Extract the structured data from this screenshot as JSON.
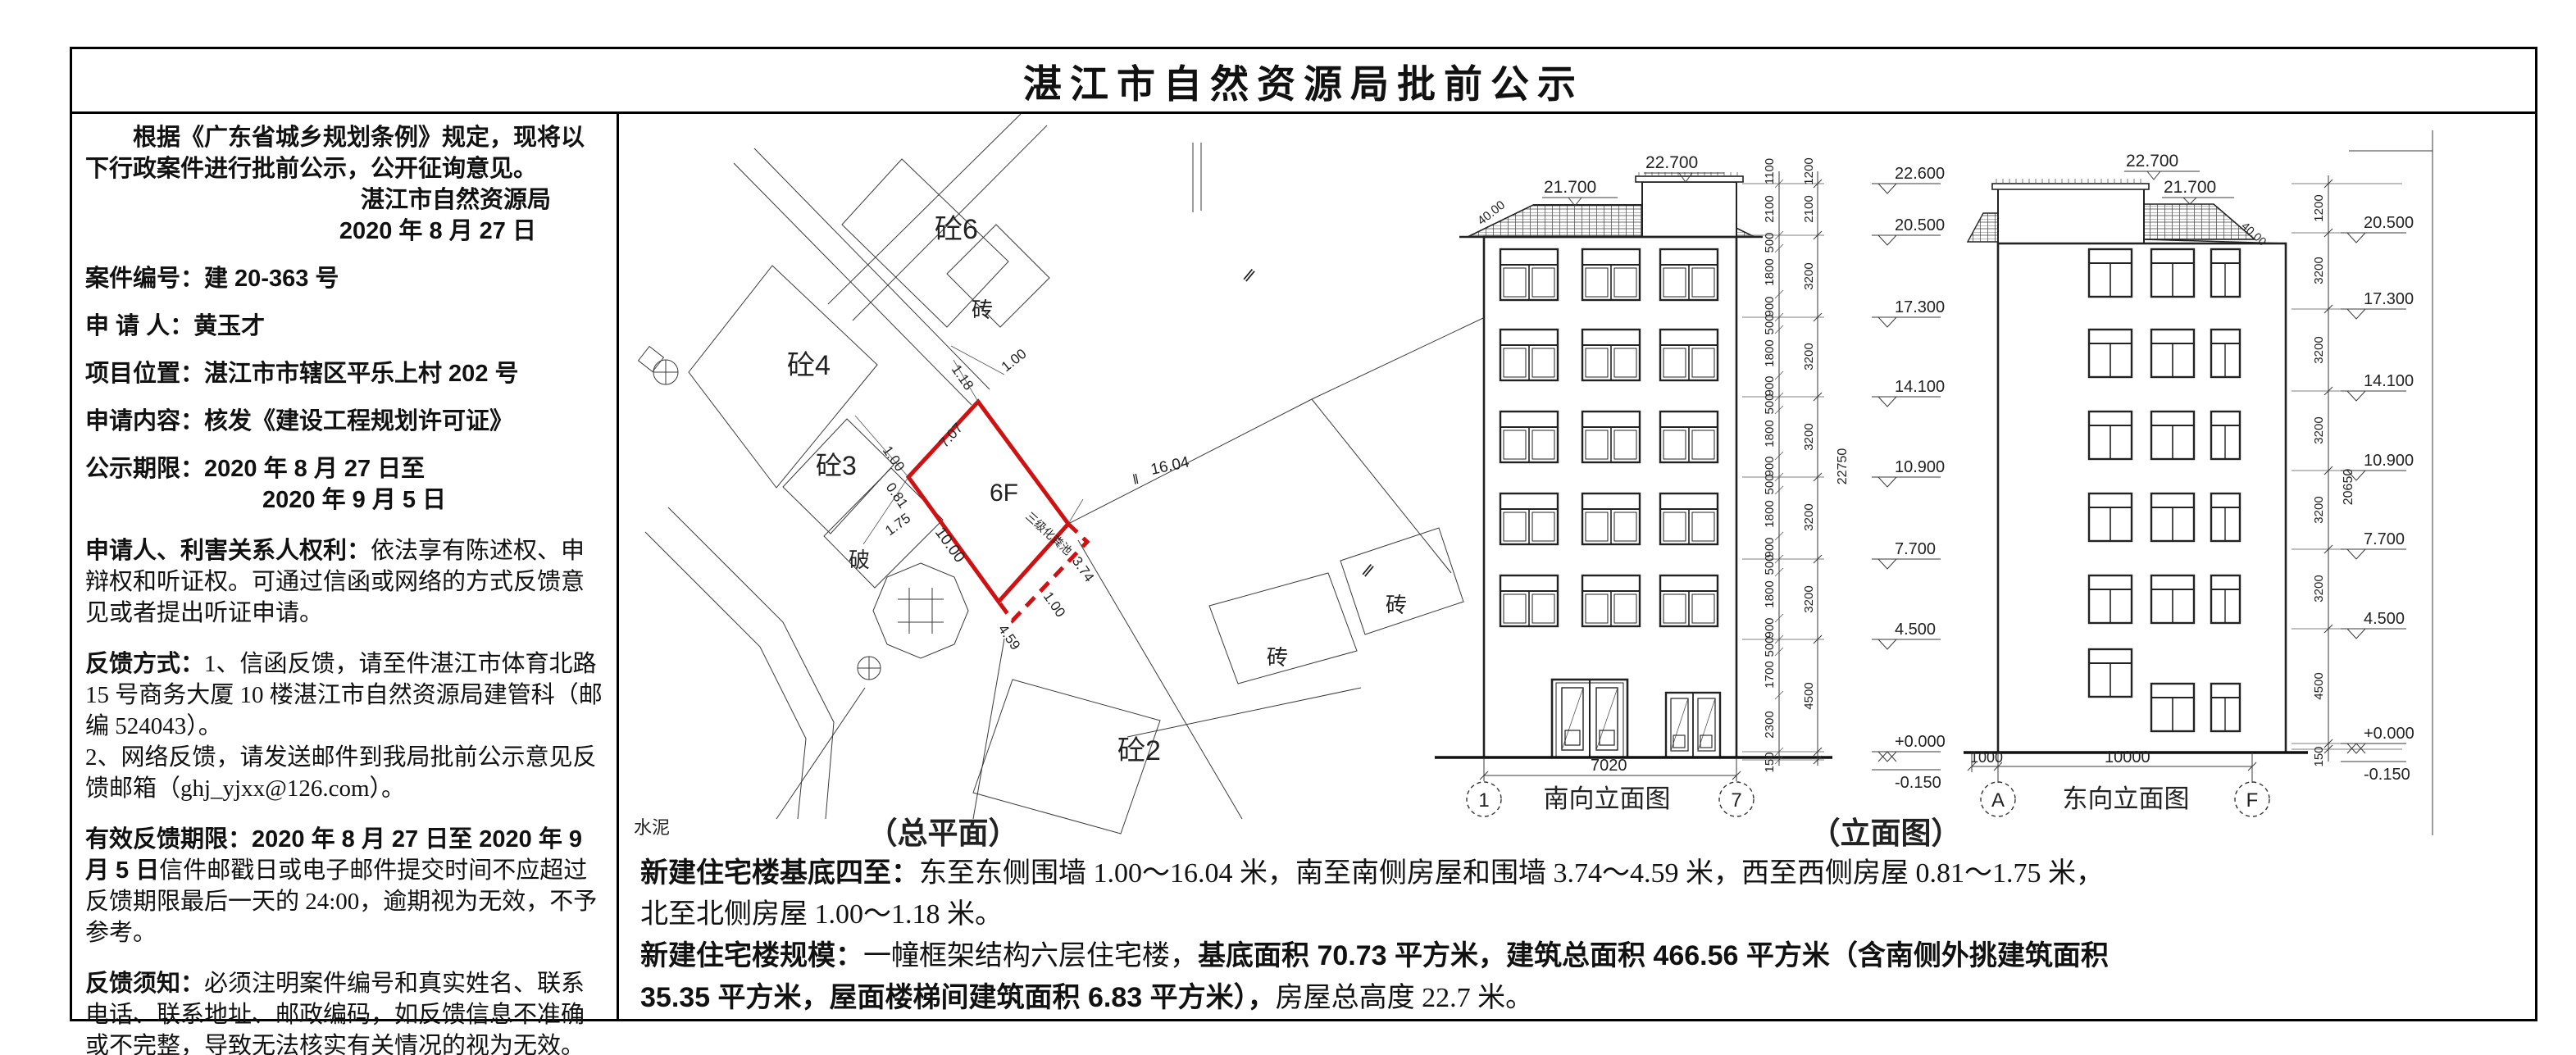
{
  "title": "湛江市自然资源局批前公示",
  "notice": {
    "intro": "根据《广东省城乡规划条例》规定，现将以下行政案件进行批前公示，公开征询意见。",
    "issuer": "湛江市自然资源局",
    "issue_date": "2020 年 8 月 27 日",
    "case_no": "案件编号：建 20-363 号",
    "applicant": "申 请 人：黄玉才",
    "location": "项目位置：湛江市市辖区平乐上村 202 号",
    "content": "申请内容：核发《建设工程规划许可证》",
    "period_line1": "公示期限：2020 年 8 月 27 日至",
    "period_line2": "2020 年 9 月 5 日",
    "rights_label": "申请人、利害关系人权利：",
    "rights_text": "依法享有陈述权、申辩权和听证权。可通过信函或网络的方式反馈意见或者提出听证申请。",
    "feedback_label": "反馈方式：",
    "feedback_text1": "1、信函反馈，请至件湛江市体育北路 15 号商务大厦 10 楼湛江市自然资源局建管科（邮编 524043）。",
    "feedback_text2": "2、网络反馈，请发送邮件到我局批前公示意见反馈邮箱（ghj_yjxx@126.com）。",
    "valid_label": "有效反馈期限：",
    "valid_dates": "2020 年 8 月 27 日至 2020 年 9 月 5 日",
    "valid_text": "信件邮戳日或电子邮件提交时间不应超过反馈期限最后一天的 24:00，逾期视为无效，不予参考。",
    "notes_label": "反馈须知：",
    "notes_text": "必须注明案件编号和真实姓名、联系电话、联系地址、邮政编码，如反馈信息不准确或不完整，导致无法核实有关情况的视为无效。"
  },
  "site_plan": {
    "caption": "（总平面）",
    "label_6f": "6F",
    "septic": "三级化粪池",
    "con4": "砼4",
    "con6": "砼6",
    "con3": "砼3",
    "con2": "砼2",
    "brick": "砖",
    "broken": "破",
    "cement": "水泥",
    "break_mark": "‖",
    "dims": {
      "n1": "1.18",
      "n2": "1.00",
      "nw": "7.07",
      "e": "16.04",
      "w1": "0.81",
      "w2": "1.00",
      "w3": "1.75",
      "sw": "10.00",
      "s1": "3.74",
      "s2": "1.00",
      "s3": "4.59"
    }
  },
  "south_elev": {
    "title": "南向立面图",
    "axis_l": "1",
    "axis_r": "7",
    "width": "7020",
    "lvl_top": "22.700",
    "lvl_ridge": "21.700",
    "slope": "40.00",
    "total": "22750",
    "levels": [
      "22.600",
      "20.500",
      "17.300",
      "14.100",
      "10.900",
      "7.700",
      "4.500",
      "+0.000",
      "-0.150"
    ],
    "storeys": [
      "1200",
      "2100",
      "3200",
      "3200",
      "3200",
      "3200",
      "3200",
      "4500"
    ],
    "details": [
      "1100",
      "2100",
      "500",
      "1800",
      "900",
      "500",
      "1800",
      "900",
      "500",
      "1800",
      "900",
      "500",
      "1800",
      "900",
      "500",
      "1800",
      "900",
      "500",
      "1700",
      "2300",
      "150"
    ]
  },
  "east_elev": {
    "title": "东向立面图",
    "axis_l": "A",
    "axis_r": "F",
    "dim_small": "1000",
    "dim_main": "10000",
    "lvl_top": "22.700",
    "lvl_ridge": "21.700",
    "slope": "40.00",
    "total": "20650",
    "levels": [
      "20.500",
      "17.300",
      "14.100",
      "10.900",
      "7.700",
      "4.500",
      "+0.000",
      "-0.150"
    ],
    "storeys": [
      "1200",
      "3200",
      "3200",
      "3200",
      "3200",
      "3200",
      "4500",
      "150"
    ]
  },
  "elevation_caption": "（立面图）",
  "footer": {
    "l1a": "新建住宅楼基底四至：",
    "l1b": "东至东侧围墙 1.00～16.04 米，南至南侧房屋和围墙 3.74～4.59 米，西至西侧房屋 0.81～1.75 米，",
    "l2": "北至北侧房屋 1.00～1.18 米。",
    "l3a": "新建住宅楼规模：",
    "l3b": "一幢框架结构六层住宅楼，",
    "l3c": "基底面积 70.73 平方米，建筑总面积 466.56 平方米（含南侧外挑建筑面积",
    "l4a": "35.35 平方米，屋面楼梯间建筑面积 6.83 平方米），",
    "l4b": "房屋总高度 22.7 米。"
  }
}
